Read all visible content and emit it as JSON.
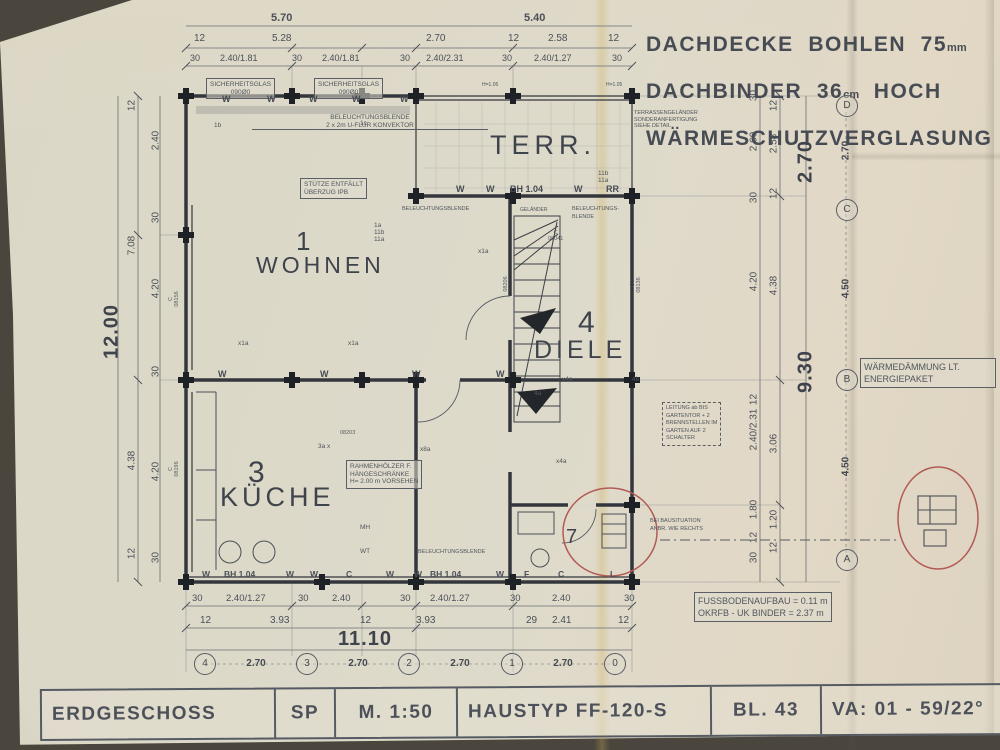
{
  "header": {
    "line1": "DACHDECKE  BOHLEN  75",
    "line1_unit": "mm",
    "line2": "DACHBINDER  36",
    "line2_unit": "cm",
    "line2_suffix": "  HOCH",
    "line3": "WÄRMESCHUTZVERGLASUNG"
  },
  "title_block": {
    "cells": [
      "ERDGESCHOSS",
      "SP",
      "M. 1:50",
      "HAUSTYP  FF-120-S",
      "BL. 43",
      "VA: 01 - 59/22°"
    ]
  },
  "rooms": {
    "wohnen_no": "1",
    "wohnen": "WOHNEN",
    "terr": "TERR.",
    "diele_no": "4",
    "diele": "DIELE",
    "kueche_no": "3",
    "kueche": "KÜCHE",
    "bad_no": "7"
  },
  "notes": {
    "sicherheitsglas1": "SICHERHEITSGLAS\n090Ø0",
    "sicherheitsglas2": "SICHERHEITSGLAS\n090Ø0",
    "blende_konvektor": "BELEUCHTUNGSBLENDE\n2 x 2m U-FLUR KONVEKTOR",
    "stuetze": "STÜTZE ENTFÄLLT\nÜBERZUG IPB",
    "terrasse": "TERRASSENGELÄNDER\nSONDERANFERTIGUNG\nSIEHE DETAIL",
    "beleuchtung2": "BELEUCHTUNGSBLENDE",
    "beleuchtung3": "BELEUCHTUNGS-\nBLENDE",
    "beleuchtung4": "BELEUCHTUNGSBLENDE",
    "rahmenhoelzer": "RAHMENHÖLZER F.\nHÄNGESCHRÄNKE\nH= 2.00 m VORSEHEN",
    "leitung": "LEITUNG ab BIS\nGARTENTOR + 2\nBRENNSTELLEN IM\nGARTEN AUF 2\nSCHALTER",
    "bausituation": "BEI BAUSITUATION\nANBR. WIE RECHTS",
    "waermedaemmung": "WÄRMEDÄMMUNG LT.\nENERGIEPAKET",
    "fussboden": "FUSSBODENAUFBAU = 0.11 m\nOKRFB - UK BINDER = 2.37 m"
  },
  "dims": {
    "top1": [
      "5.70",
      "5.40"
    ],
    "top2": [
      "12",
      "5.28",
      "2.70",
      "12",
      "2.58",
      "12"
    ],
    "top3": [
      "30",
      "2.40/1.81",
      "30",
      "2.40/1.81",
      "30",
      "2.40/2.31",
      "30",
      "2.40/1.27",
      "30"
    ],
    "left_big": "12.00",
    "left_mid": [
      "12",
      "7.08",
      "4.38",
      "12"
    ],
    "left_inner": [
      "2.40",
      "30",
      "4.20",
      "30",
      "4.20",
      "30"
    ],
    "right_chain1": [
      "30",
      "2.60",
      "30",
      "4.20",
      "12",
      "2.40/2.31",
      "1.80",
      "12",
      "30"
    ],
    "right_chain2": [
      "12",
      "2.58",
      "12",
      "4.38",
      "3.06",
      "1.20",
      "12"
    ],
    "right_big1": "2.70",
    "right_big2": "9.30",
    "bottom_win": [
      "W",
      "BH 1.04",
      "W",
      "W",
      "C",
      "W",
      "W",
      "BH 1.04",
      "W",
      "F",
      "C",
      "L"
    ],
    "bottom2": [
      "30",
      "2.40/1.27",
      "30",
      "2.40",
      "30",
      "2.40/1.27",
      "30",
      "2.40",
      "30"
    ],
    "bottom3": [
      "12",
      "3.93",
      "12",
      "3.93",
      "29",
      "2.41",
      "12"
    ],
    "bottom_big": "11.10"
  },
  "axes": {
    "bottom_ids": [
      "4",
      "3",
      "2",
      "1",
      "0"
    ],
    "bottom_spans": [
      "2.70",
      "2.70",
      "2.70",
      "2.70"
    ],
    "right_ids": [
      "D",
      "C",
      "B",
      "A"
    ],
    "right_spans": [
      "2.70",
      "4.50",
      "4.50"
    ]
  },
  "marks": {
    "top_w": [
      "W",
      "W",
      "W",
      "W",
      "W"
    ],
    "terr_row": [
      "W",
      "W",
      "BH 1.04",
      "W",
      "RR"
    ],
    "mid_w": [
      "W",
      "W",
      "W",
      "W"
    ]
  },
  "codes": {
    "c08041": "C\n08041",
    "c08156": "C\n08156",
    "c08196": "C\n08196",
    "c08136": "C\n08136",
    "l08206": "08206",
    "l08203": "08203"
  },
  "small": {
    "l1b": "1b",
    "l1c": "1c",
    "cluster": "1a\n11b\n11a",
    "t11": "11b\n11a",
    "x1a_a": "x1a",
    "x1a_b": "x1a",
    "x1a_c": "x1a",
    "x4a_a": "x4a",
    "x4a_b": "x4a",
    "l4a": "4a",
    "l4b": "4b",
    "l3a": "3a x",
    "x8a": "x8a",
    "mh": "MH",
    "wt": "WT",
    "h105a": "H=1.05",
    "h105b": "H=1.05",
    "gelaender": "GELÄNDER"
  }
}
